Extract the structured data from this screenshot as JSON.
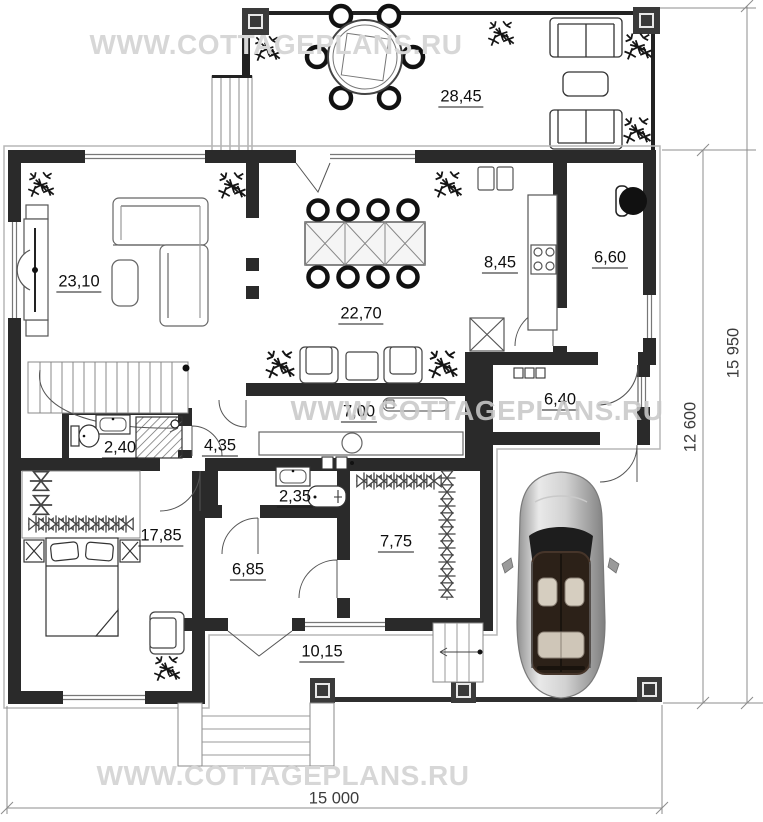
{
  "watermark": {
    "text": "WWW.COTTAGEPLANS.RU"
  },
  "rooms": {
    "terrace": {
      "area": "28,45"
    },
    "living": {
      "area": "23,10"
    },
    "dining": {
      "area": "22,70"
    },
    "kitchen": {
      "area": "8,45"
    },
    "boiler": {
      "area": "6,60"
    },
    "vestibule": {
      "area": "6,40"
    },
    "corridor": {
      "area": "7,00"
    },
    "wc": {
      "area": "2,40"
    },
    "hall": {
      "area": "4,35"
    },
    "bathroom": {
      "area": "2,35"
    },
    "bedroom": {
      "area": "17,85"
    },
    "hall2": {
      "area": "6,85"
    },
    "wardrobe": {
      "area": "7,75"
    },
    "porch": {
      "area": "10,15"
    }
  },
  "dimensions": {
    "overall_height": "15 950",
    "main_height": "12 600",
    "overall_width": "15 000"
  },
  "colors": {
    "wall": "#2a2a2a",
    "watermark": "#d4d4d4",
    "dimension_text": "#3c3c3c"
  }
}
